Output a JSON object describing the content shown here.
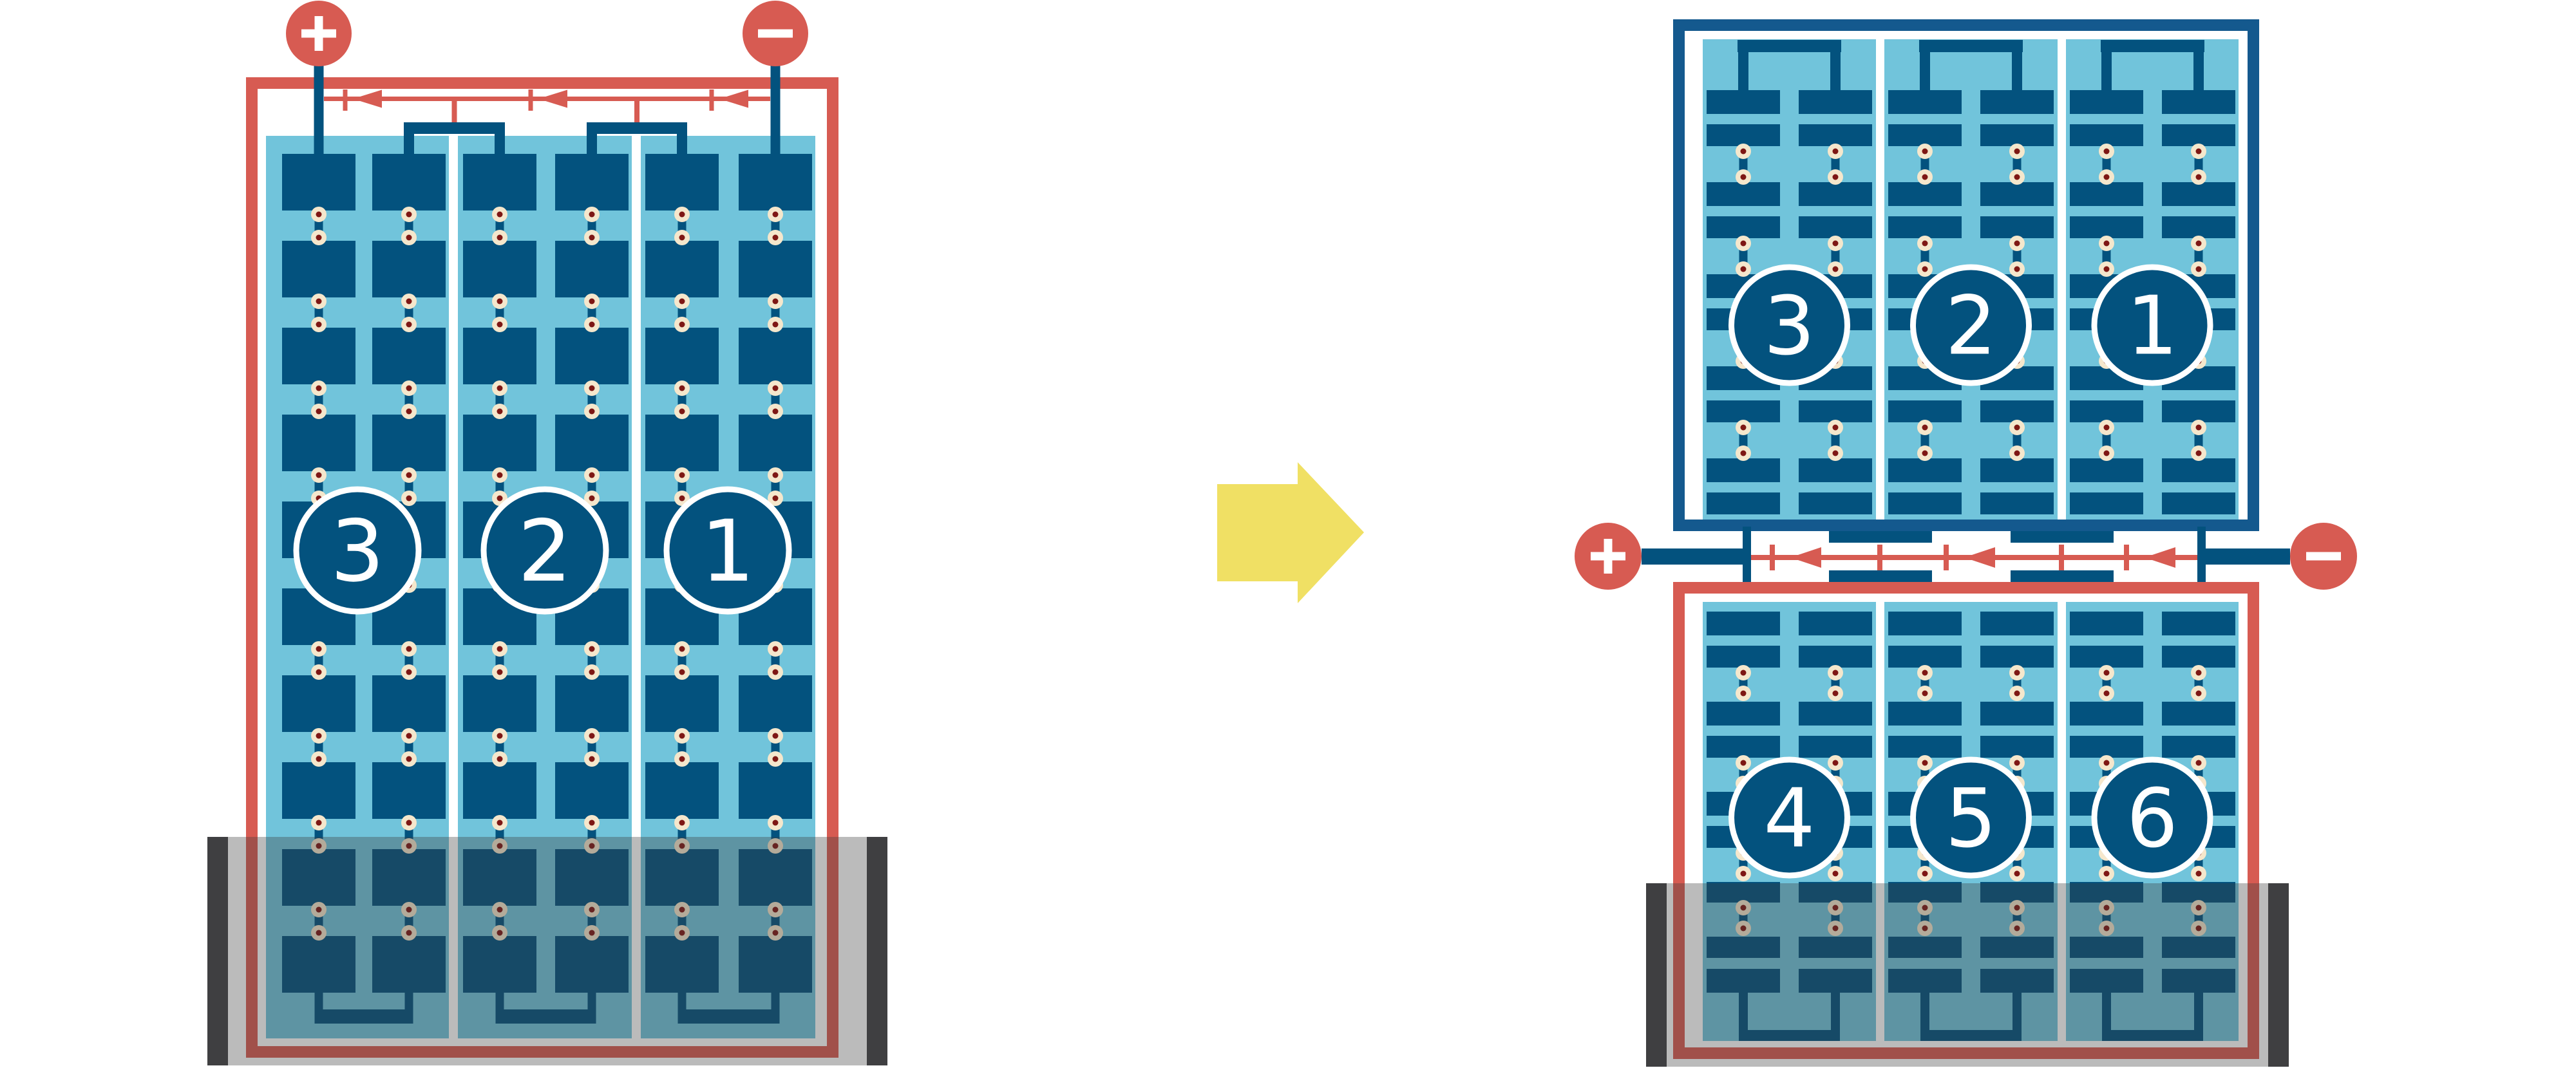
{
  "diagram_title": "lead-acid battery cell arrangement diagram",
  "colors": {
    "red": "#D75B52",
    "plate_blue": "#03527E",
    "frame_blue": "#14598E",
    "light_blue": "#71C4DB",
    "rivet_cream": "#F5E7CC",
    "rivet_core": "#7E1714",
    "arrow_yellow": "#F0E064",
    "case_gray": "#3F3F41",
    "case_overlay": "rgba(60,60,60,0.35)",
    "white": "#FFFFFF"
  },
  "left_battery": {
    "positive_terminal": {
      "symbol": "+"
    },
    "negative_terminal": {
      "symbol": "−"
    },
    "cells": [
      {
        "number": "3"
      },
      {
        "number": "2"
      },
      {
        "number": "1"
      }
    ]
  },
  "right_battery": {
    "positive_terminal": {
      "symbol": "+"
    },
    "negative_terminal": {
      "symbol": "−"
    },
    "top_row_cells": [
      {
        "number": "3"
      },
      {
        "number": "2"
      },
      {
        "number": "1"
      }
    ],
    "bottom_row_cells": [
      {
        "number": "4"
      },
      {
        "number": "5"
      },
      {
        "number": "6"
      }
    ]
  },
  "transform_arrow": {
    "icon": "right-arrow-icon"
  }
}
